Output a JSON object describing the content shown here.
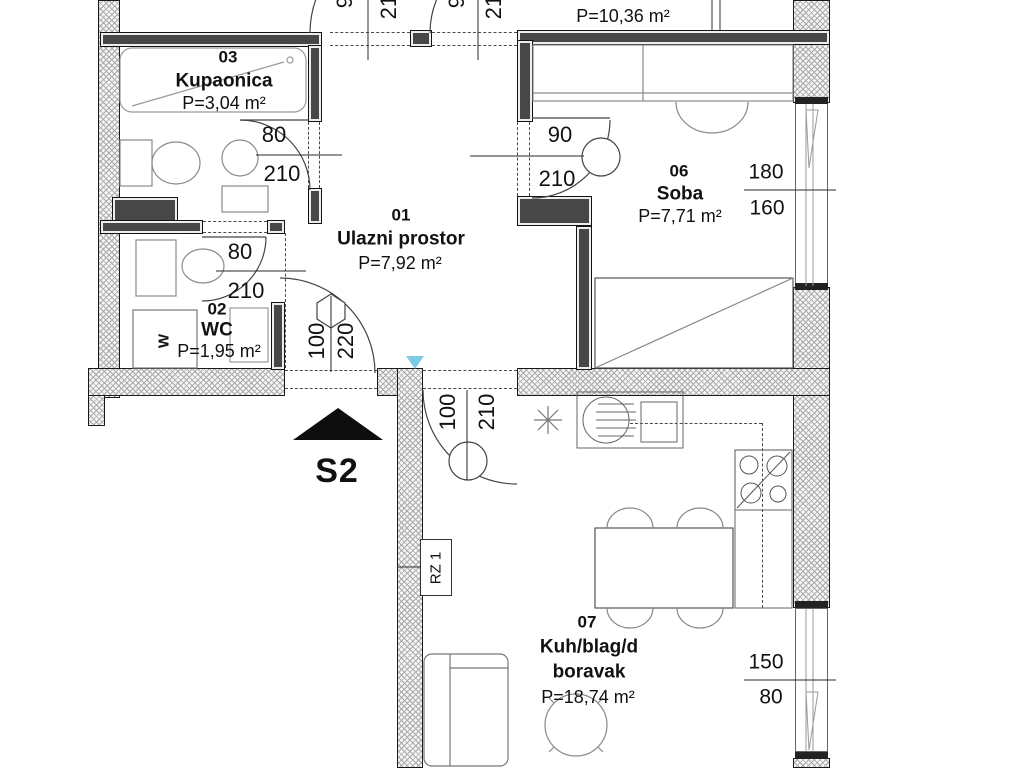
{
  "labels": {
    "unit": "S2",
    "riser": "RZ 1",
    "washer": "W"
  },
  "rooms": {
    "entry": {
      "number": "01",
      "name": "Ulazni prostor",
      "area": "P=7,92 m²"
    },
    "wc": {
      "number": "02",
      "name": "WC",
      "area": "P=1,95 m²"
    },
    "bath": {
      "number": "03",
      "name": "Kupaonica",
      "area": "P=3,04 m²"
    },
    "bedroom": {
      "number": "06",
      "name": "Soba",
      "area": "P=7,71 m²"
    },
    "living": {
      "number": "07",
      "name": "Kuh/blag/d",
      "name2": "boravak",
      "area": "P=18,74 m²"
    },
    "bedroom_top": {
      "name": "Soba",
      "area": "P=10,36 m²"
    }
  },
  "dims": {
    "bath_door": {
      "w": "80",
      "h": "210"
    },
    "wc_door": {
      "w": "80",
      "h": "210"
    },
    "bedroom_door": {
      "w": "90",
      "h": "210"
    },
    "entry_door": {
      "w": "100",
      "h": "220"
    },
    "living_door": {
      "w": "100",
      "h": "210"
    },
    "top_door_left": {
      "w": "90",
      "h": "210"
    },
    "top_door_right": {
      "w": "90",
      "h": "210"
    },
    "bedroom_window": {
      "w": "180",
      "h": "160"
    },
    "living_window": {
      "w": "150",
      "h": "80"
    }
  }
}
